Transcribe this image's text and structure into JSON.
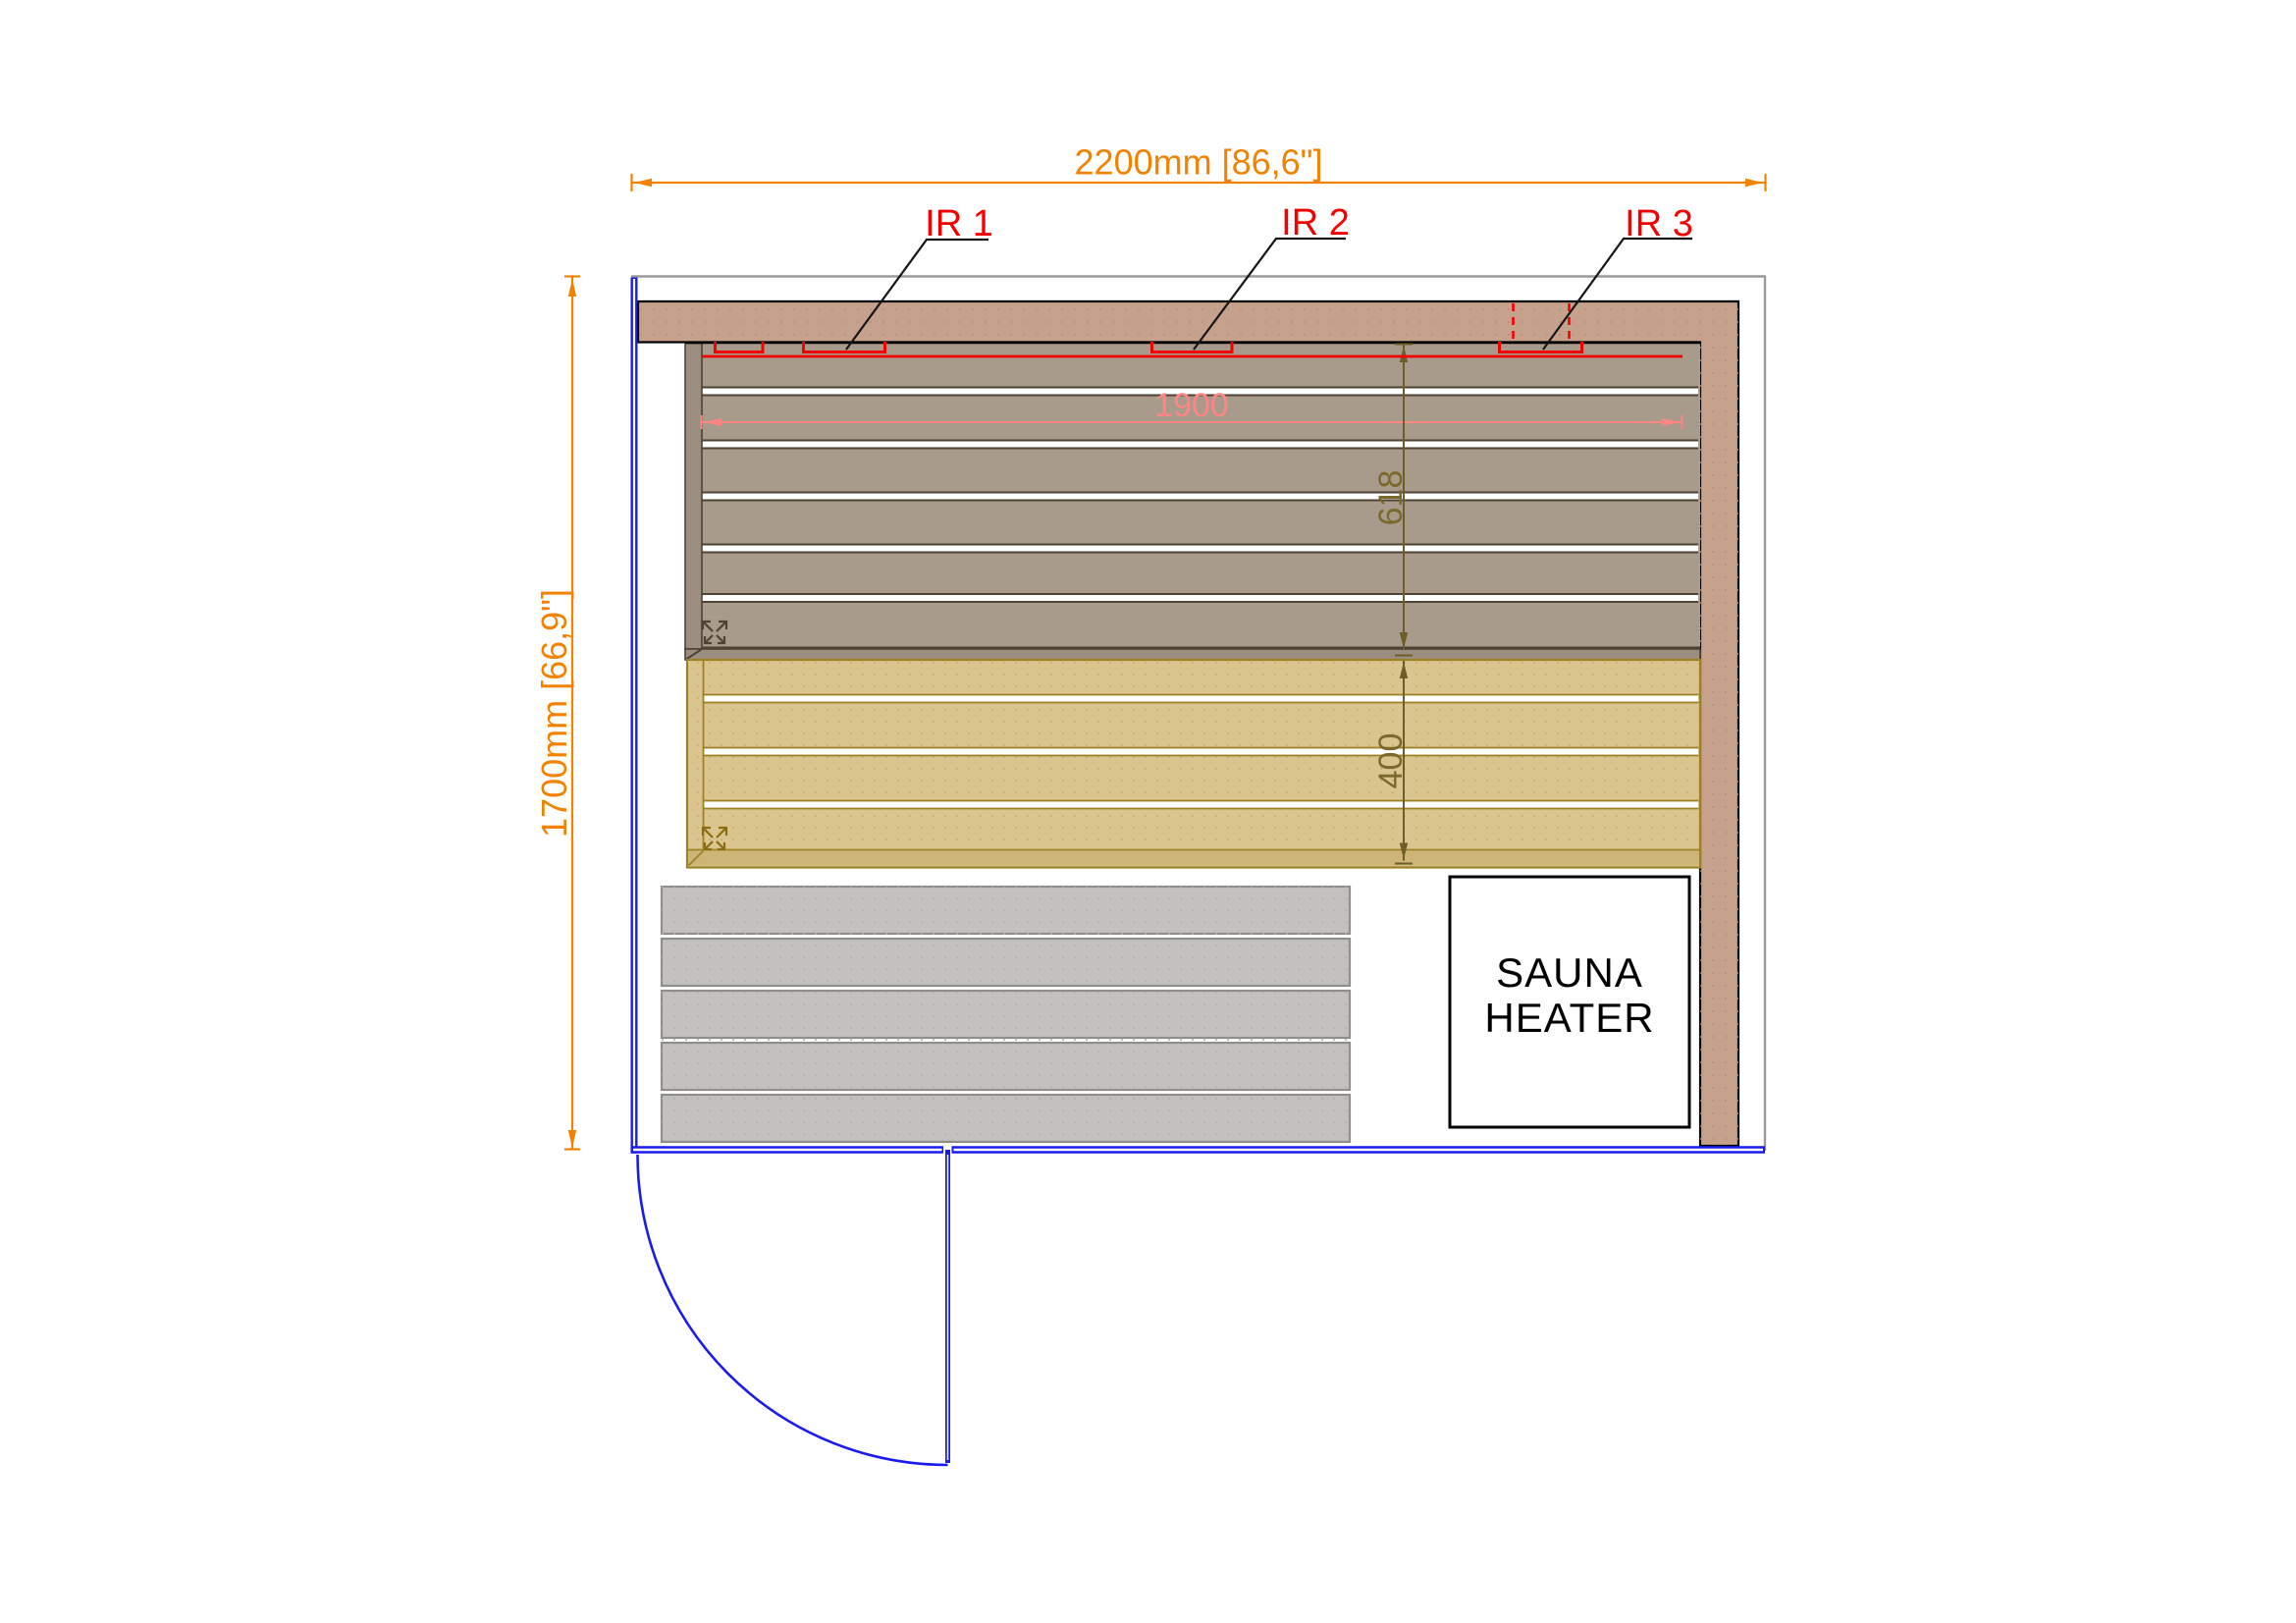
{
  "drawing": {
    "type": "sauna floor plan"
  },
  "dimensions": {
    "overall_width": "2200mm [86,6\"]",
    "overall_depth": "1700mm [66,9\"]",
    "bench_length": "1900",
    "upper_bench_depth": "618",
    "lower_bench_depth": "400"
  },
  "ir_panels": [
    {
      "label": "IR 1"
    },
    {
      "label": "IR 2"
    },
    {
      "label": "IR 3"
    }
  ],
  "heater": {
    "line1": "SAUNA",
    "line2": "HEATER"
  },
  "colors": {
    "wall_blue": "#1b1bf0",
    "outline_gray": "#9a9a9a",
    "dim_orange": "#f28200",
    "dim_pink": "#ff8585",
    "dim_olive": "#6e5d28",
    "dim_olive_text": "#7a692c",
    "ir_red": "#f50000",
    "leader_black": "#161616",
    "wood_tan": "#c6a28c",
    "bench_gray": "#a89b8b",
    "bench_gray_dark": "#9b8e80",
    "bench_edge_brown": "#4e4233",
    "bench_yellow": "#d9c58d",
    "bench_yellow_dark": "#ccb577",
    "bench_yellow_edge": "#9d8126",
    "bench_yellow_icon": "#8a6d15",
    "floor_gray": "#c2c1bf",
    "floor_gray_edge": "#8f8e8a"
  }
}
